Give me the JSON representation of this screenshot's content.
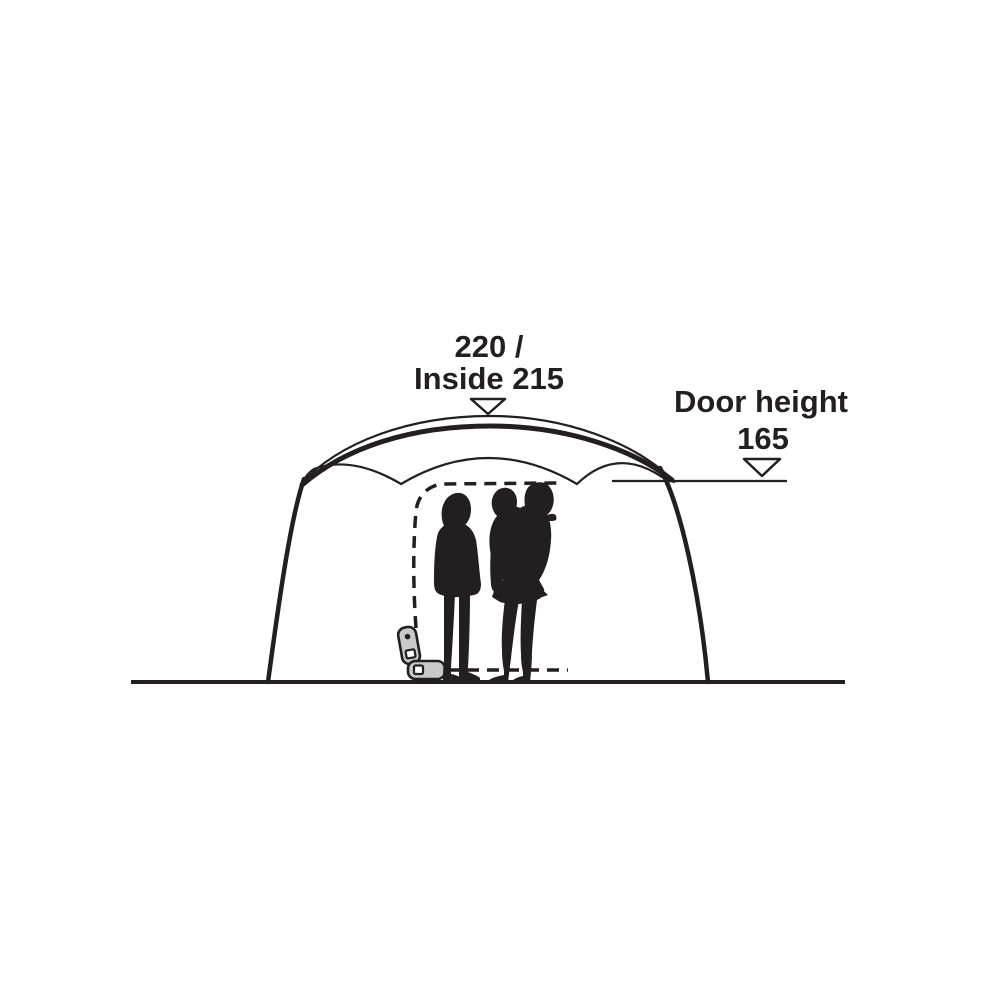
{
  "diagram": {
    "type": "tent-dimension-side-view",
    "annotations": {
      "peak_height": {
        "line1": "220 /",
        "line2": "Inside 215",
        "marker": "down-arrow"
      },
      "door_height": {
        "label": "Door height",
        "value": "165",
        "marker": "down-arrow"
      }
    },
    "colors": {
      "ink": "#231f20",
      "background": "#ffffff",
      "zipper_fill": "#c9c9c9"
    }
  }
}
